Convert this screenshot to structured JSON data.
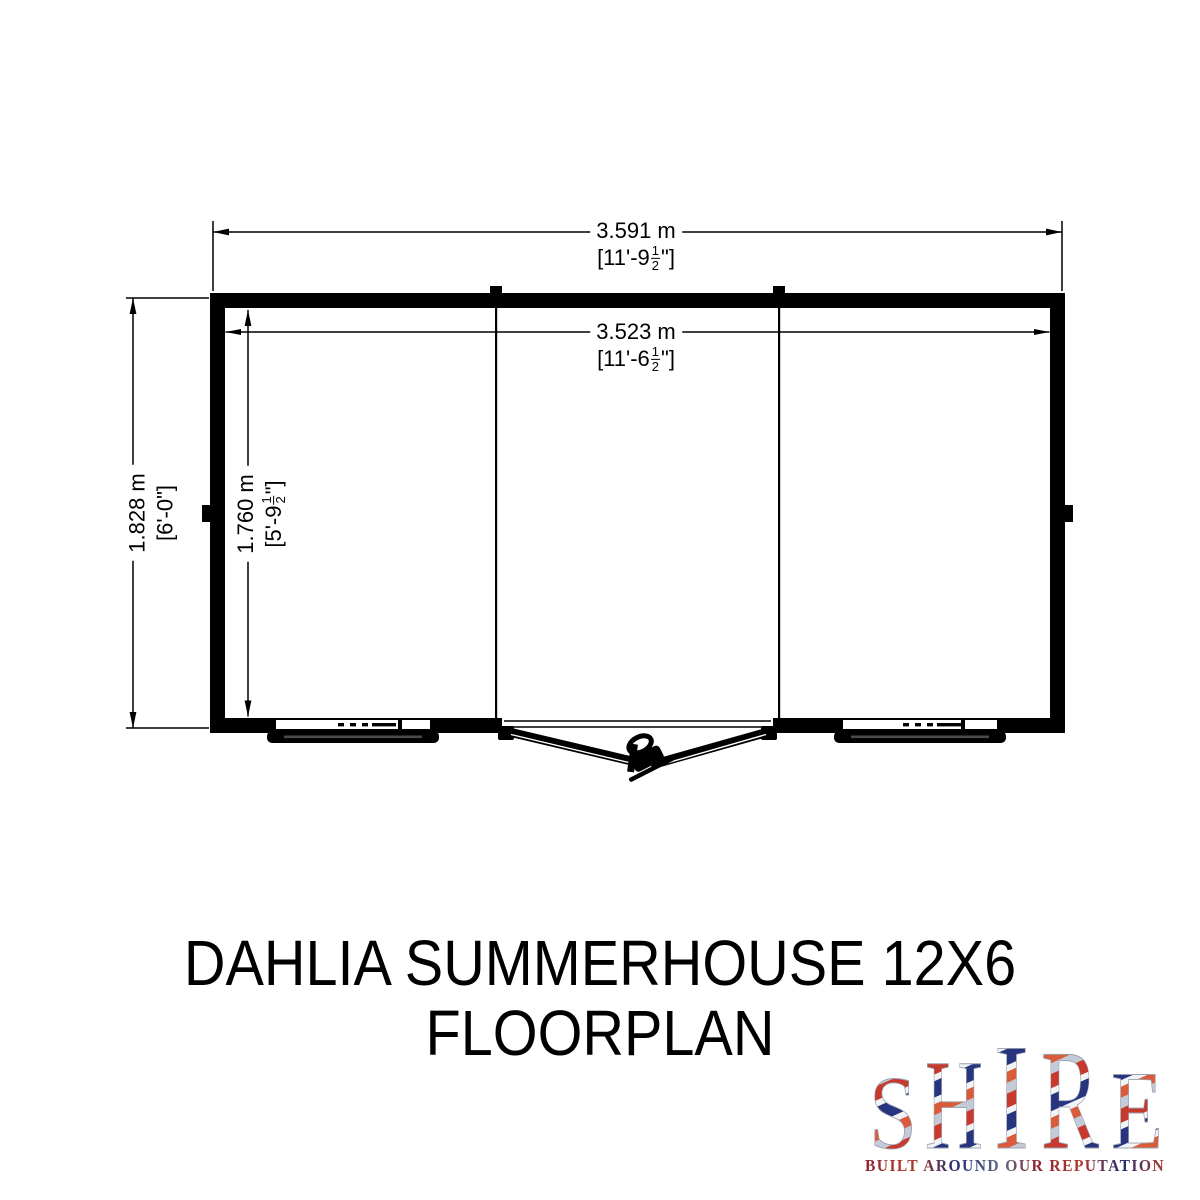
{
  "title": {
    "line1": "DAHLIA SUMMERHOUSE 12X6",
    "line2": "FLOORPLAN"
  },
  "dimensions": {
    "outer_width": {
      "metric": "3.591 m",
      "imperial_prefix": "[11'-9",
      "frac_num": "1",
      "frac_den": "2",
      "imperial_suffix": "\"]"
    },
    "inner_width": {
      "metric": "3.523 m",
      "imperial_prefix": "[11'-6",
      "frac_num": "1",
      "frac_den": "2",
      "imperial_suffix": "\"]"
    },
    "outer_depth": {
      "metric": "1.828 m",
      "imperial_prefix": "[6'-0\"]"
    },
    "inner_depth": {
      "metric": "1.760 m",
      "imperial_prefix": "[5'-9",
      "frac_num": "1",
      "frac_den": "2",
      "imperial_suffix": "\"]"
    }
  },
  "floorplan": {
    "bays": 3,
    "features": [
      "double-door",
      "window",
      "window"
    ]
  },
  "logo": {
    "letters": [
      "S",
      "H",
      "I",
      "R",
      "E"
    ],
    "tagline": "BUILT AROUND OUR REPUTATION",
    "colors": {
      "red": "#c8392d",
      "orange_red": "#da5a3a",
      "blue": "#27357f",
      "silver": "#c3cbd8",
      "white": "#f2f3f6"
    }
  }
}
